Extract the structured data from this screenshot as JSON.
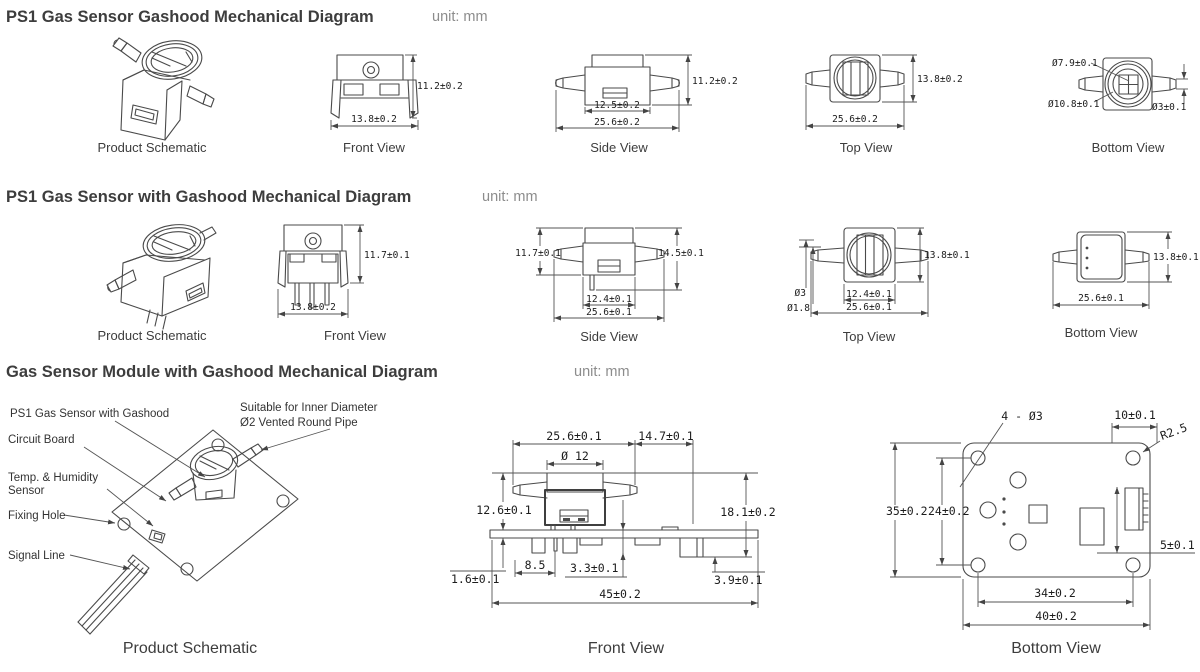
{
  "s1": {
    "title": "PS1 Gas Sensor Gashood Mechanical  Diagram",
    "unit": "unit: mm",
    "labels": {
      "schematic": "Product Schematic",
      "front": "Front View",
      "side": "Side View",
      "top": "Top View",
      "bottom": "Bottom View"
    },
    "front": {
      "h": "11.2±0.2",
      "w": "13.8±0.2"
    },
    "side": {
      "h": "11.2±0.2",
      "wi": "12.5±0.2",
      "wo": "25.6±0.2"
    },
    "top": {
      "h": "13.8±0.2",
      "w": "25.6±0.2"
    },
    "bottom": {
      "d1": "Ø7.9±0.1",
      "d2": "Ø10.8±0.1",
      "d3": "Ø3±0.1"
    }
  },
  "s2": {
    "title": "PS1 Gas Sensor with Gashood Mechanical  Diagram",
    "unit": "unit: mm",
    "labels": {
      "schematic": "Product Schematic",
      "front": "Front View",
      "side": "Side View",
      "top": "Top View",
      "bottom": "Bottom View"
    },
    "front": {
      "h": "11.7±0.1",
      "w": "13.8±0.2"
    },
    "side": {
      "hl": "11.7±0.1",
      "hr": "14.5±0.1",
      "wi": "12.4±0.1",
      "wo": "25.6±0.1"
    },
    "top": {
      "p1": "Ø3",
      "p2": "Ø1.8",
      "h": "13.8±0.1",
      "wi": "12.4±0.1",
      "wo": "25.6±0.1"
    },
    "bottom": {
      "h": "13.8±0.1",
      "w": "25.6±0.1"
    }
  },
  "s3": {
    "title": "Gas Sensor Module with Gashood Mechanical  Diagram",
    "unit": "unit: mm",
    "labels": {
      "schematic": "Product Schematic",
      "front": "Front View",
      "bottom": "Bottom View"
    },
    "callouts": {
      "sensor": "PS1 Gas Sensor with Gashood",
      "pipe1": "Suitable for Inner Diameter",
      "pipe2": "Ø2 Vented Round Pipe",
      "board": "Circuit Board",
      "temp1": "Temp. & Humidity",
      "temp2": "Sensor",
      "hole": "Fixing Hole",
      "signal": "Signal Line"
    },
    "front": {
      "w1": "25.6±0.1",
      "w2": "14.7±0.1",
      "d": "Ø 12",
      "h1": "12.6±0.1",
      "h2": "18.1±0.2",
      "t": "1.6±0.1",
      "p1": "8.5",
      "p2": "3.3±0.1",
      "p3": "3.9±0.1",
      "w3": "45±0.2"
    },
    "bottom": {
      "holes": "4 - Ø3",
      "w1": "10±0.1",
      "r": "R2.5",
      "h1": "35±0.2",
      "h2": "24±0.2",
      "o": "5±0.1",
      "w2": "34±0.2",
      "w3": "40±0.2"
    }
  }
}
